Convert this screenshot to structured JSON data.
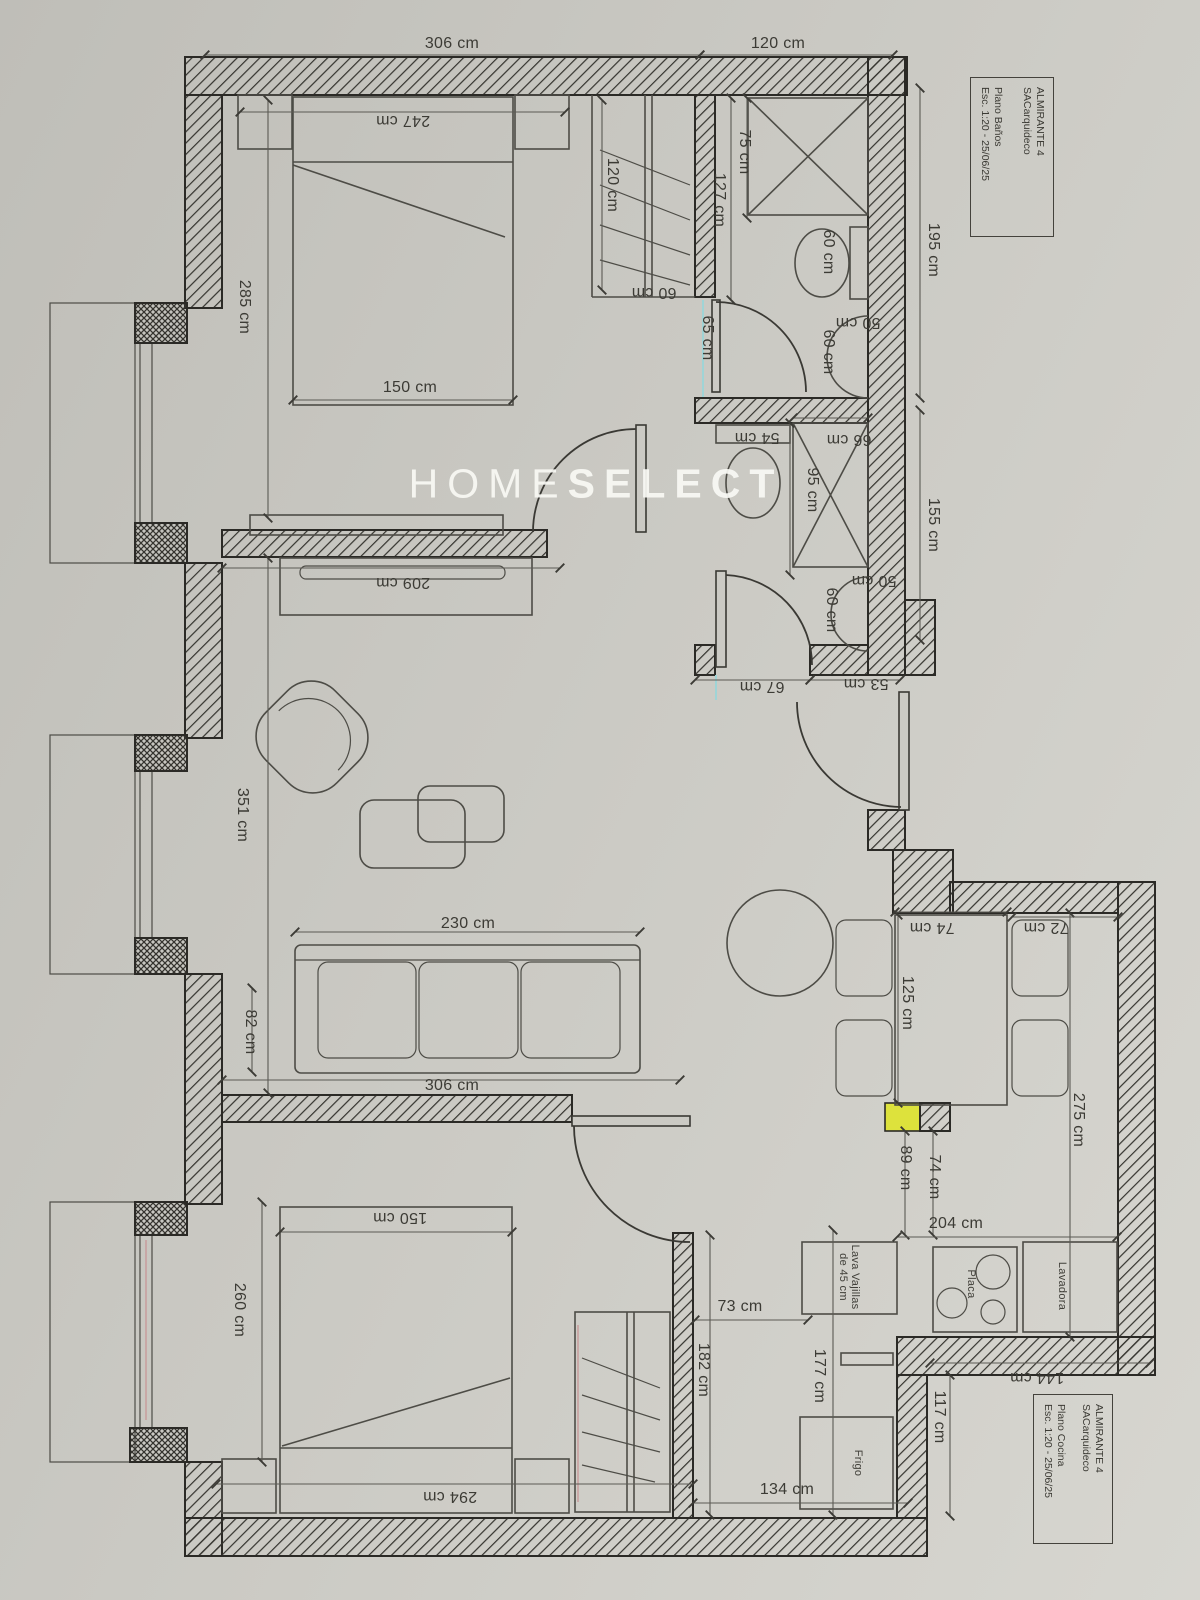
{
  "colors": {
    "paper": "#c9c8c2",
    "ink": "#3c3b35",
    "wall": "#2b2a26",
    "highlight_yellow": "#dde23c",
    "guide_cyan": "#9fd4d6",
    "guide_pink": "#c79a9a",
    "watermark": "#f9f8f4"
  },
  "watermark": {
    "light": "HOME",
    "bold": "SELECT"
  },
  "title_blocks": [
    {
      "project": "ALMIRANTE 4",
      "studio": "SACarquideco",
      "plan": "Plano Baños",
      "scale": "Esc. 1:20 - 25/06/25"
    },
    {
      "project": "ALMIRANTE 4",
      "studio": "SACarquideco",
      "plan": "Plano Cocina",
      "scale": "Esc. 1:20 - 25/06/25"
    }
  ],
  "appliances": {
    "dishwasher_l1": "Lava Vajillas",
    "dishwasher_l2": "de 45 cm",
    "hob": "Placa",
    "washer": "Lavadora",
    "fridge": "Frigo"
  },
  "dims": [
    {
      "t": "306 cm"
    },
    {
      "t": "120 cm"
    },
    {
      "t": "247 cm"
    },
    {
      "t": "285 cm"
    },
    {
      "t": "150 cm"
    },
    {
      "t": "120 cm"
    },
    {
      "t": "60 cm"
    },
    {
      "t": "75 cm"
    },
    {
      "t": "127 cm"
    },
    {
      "t": "65 cm"
    },
    {
      "t": "60 cm"
    },
    {
      "t": "50 cm"
    },
    {
      "t": "60 cm"
    },
    {
      "t": "195 cm"
    },
    {
      "t": "54 cm"
    },
    {
      "t": "66 cm"
    },
    {
      "t": "95 cm"
    },
    {
      "t": "155 cm"
    },
    {
      "t": "50 cm"
    },
    {
      "t": "60 cm"
    },
    {
      "t": "67 cm"
    },
    {
      "t": "53 cm"
    },
    {
      "t": "209 cm"
    },
    {
      "t": "351 cm"
    },
    {
      "t": "230 cm"
    },
    {
      "t": "82 cm"
    },
    {
      "t": "306 cm"
    },
    {
      "t": "125 cm"
    },
    {
      "t": "74 cm"
    },
    {
      "t": "72 cm"
    },
    {
      "t": "275 cm"
    },
    {
      "t": "89 cm"
    },
    {
      "t": "74 cm"
    },
    {
      "t": "204 cm"
    },
    {
      "t": "150 cm"
    },
    {
      "t": "260 cm"
    },
    {
      "t": "294 cm"
    },
    {
      "t": "73 cm"
    },
    {
      "t": "182 cm"
    },
    {
      "t": "177 cm"
    },
    {
      "t": "134 cm"
    },
    {
      "t": "117 cm"
    },
    {
      "t": "144 cm"
    }
  ]
}
